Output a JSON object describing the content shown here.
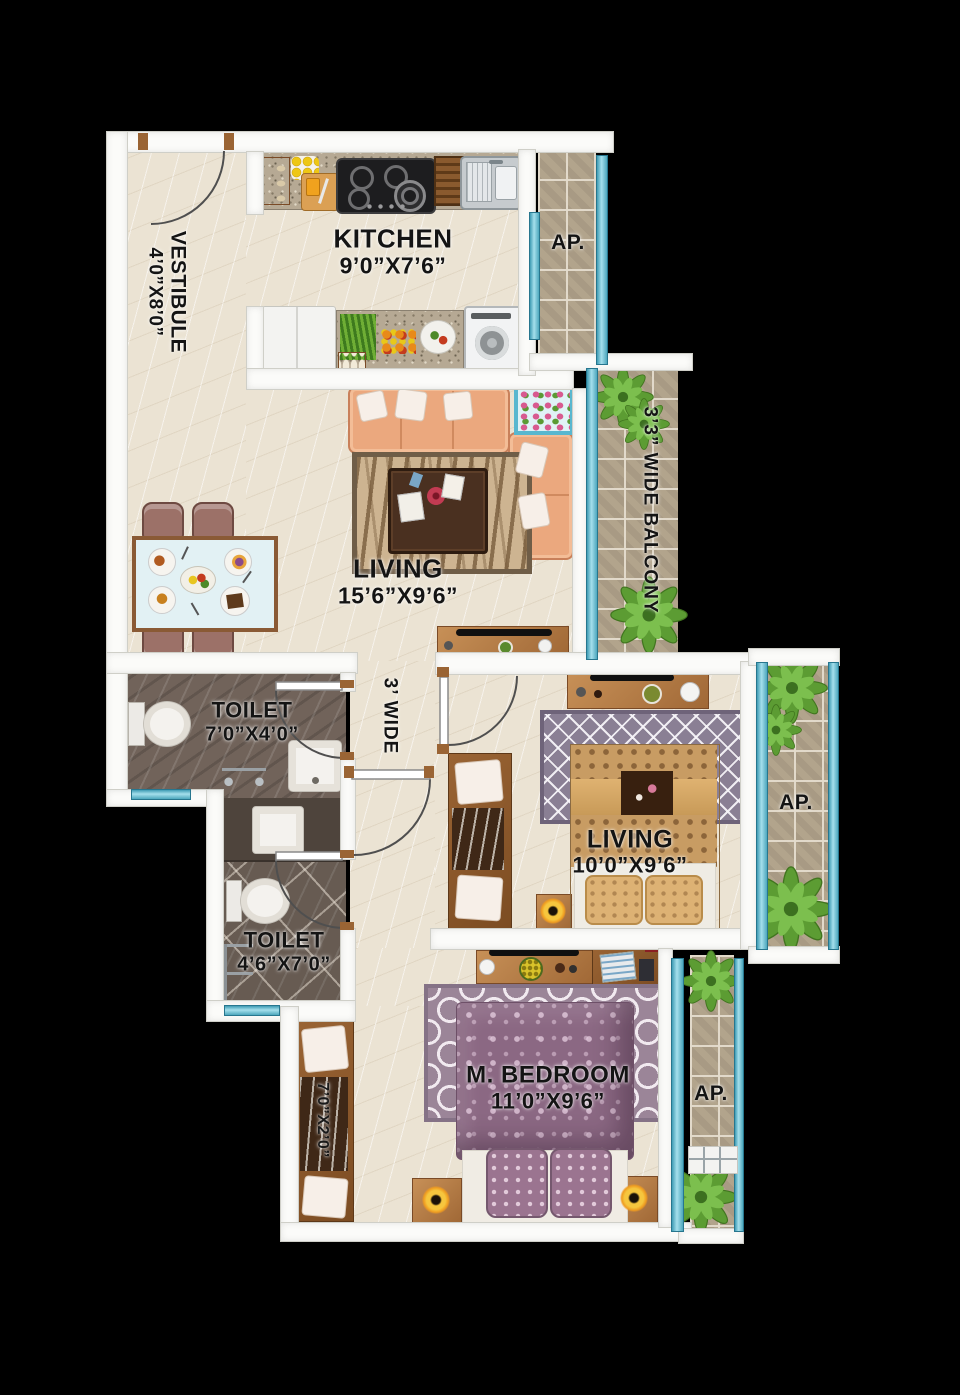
{
  "title": "Apartment Floor Plan",
  "rooms": {
    "vestibule": {
      "label": "VESTIBULE",
      "dims": "4’0”X8’0”"
    },
    "kitchen": {
      "label": "KITCHEN",
      "dims": "9’0”X7’6”"
    },
    "living": {
      "label": "LIVING",
      "dims": "15’6”X9’6”"
    },
    "balcony": {
      "label": "3’3” WIDE BALCONY"
    },
    "passage": {
      "label": "3’ WIDE"
    },
    "toilet_1": {
      "label": "TOILET",
      "dims": "7’0”X4’0”"
    },
    "toilet_2": {
      "label": "TOILET",
      "dims": "4’6”X7’0”"
    },
    "bedroom": {
      "label": "LIVING",
      "dims": "10’0”X9’6”"
    },
    "master_bedroom": {
      "label": "M. BEDROOM",
      "dims": "11’0”X9’6”"
    },
    "wardrobe": {
      "dims": "7’0”X2’0”"
    },
    "ap_top": {
      "label": "AP."
    },
    "ap_middle": {
      "label": "AP."
    },
    "ap_bottom": {
      "label": "AP."
    }
  },
  "colors": {
    "background": "#000000",
    "wall": "#fbfbf9",
    "floor_marble": "#ebe3d3",
    "floor_toilet": "#71635a",
    "floor_tile": "#b2a48c",
    "window_teal": "#7cc6d8",
    "text": "#141414",
    "wood": "#b5814f",
    "sofa": "#eba87e",
    "master_bed": "#8b6883",
    "guest_bed": "#c89c63",
    "plant": "#5c9c33"
  },
  "features": [
    "entrance-door",
    "kitchen-counter",
    "gas-stove",
    "kitchen-sink",
    "refrigerator",
    "washing-machine",
    "sofa",
    "coffee-table",
    "tv-unit",
    "dining-table",
    "dining-chair",
    "toilet-wc",
    "wash-basin",
    "shower",
    "double-bed",
    "wardrobe",
    "nightstand",
    "table-lamp",
    "study-desk",
    "desk-chair",
    "dresser",
    "rug",
    "potted-plant"
  ]
}
